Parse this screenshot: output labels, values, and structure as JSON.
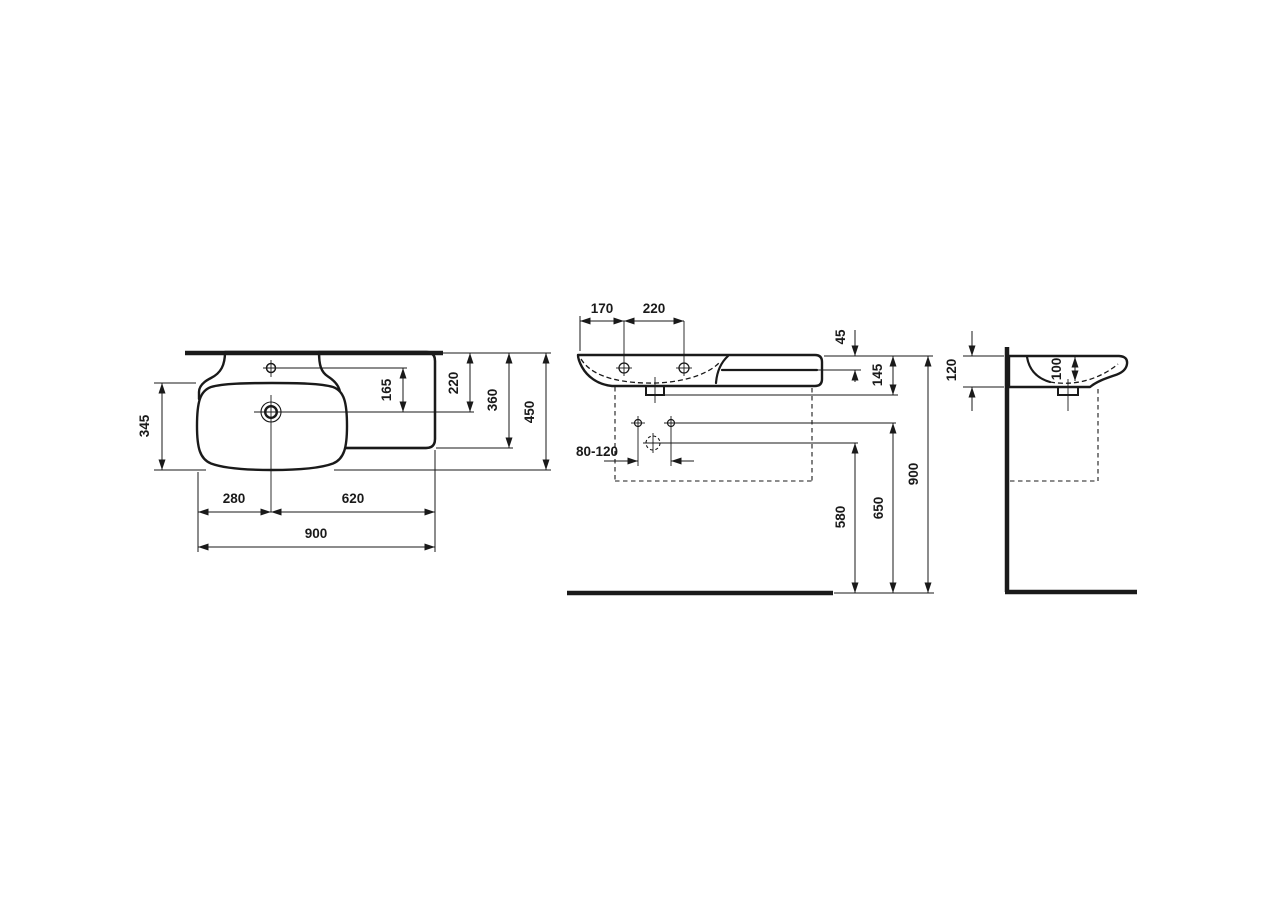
{
  "meta": {
    "title": "Washbasin technical dimension drawing, three orthographic views",
    "background": "#ffffff",
    "line_color": "#1a1a1a",
    "units": "mm"
  },
  "views": {
    "top": {
      "name": "plan view",
      "dims": {
        "bowl_depth": "345",
        "tap_to_drain": "165",
        "drain_from_wall": "220",
        "shelf_depth": "360",
        "overall_depth": "450",
        "drain_from_left": "280",
        "drain_to_right": "620",
        "overall_width": "900"
      }
    },
    "front": {
      "name": "front elevation",
      "dims": {
        "edge_to_hole": "170",
        "hole_spacing": "220",
        "shelf_thickness": "45",
        "front_height": "145",
        "supply_spacing": "80-120",
        "trap_outlet_height": "580",
        "supply_height": "650",
        "rim_height": "900"
      }
    },
    "side": {
      "name": "side elevation",
      "dims": {
        "back_height": "120",
        "bowl_inner_depth": "100"
      }
    }
  }
}
